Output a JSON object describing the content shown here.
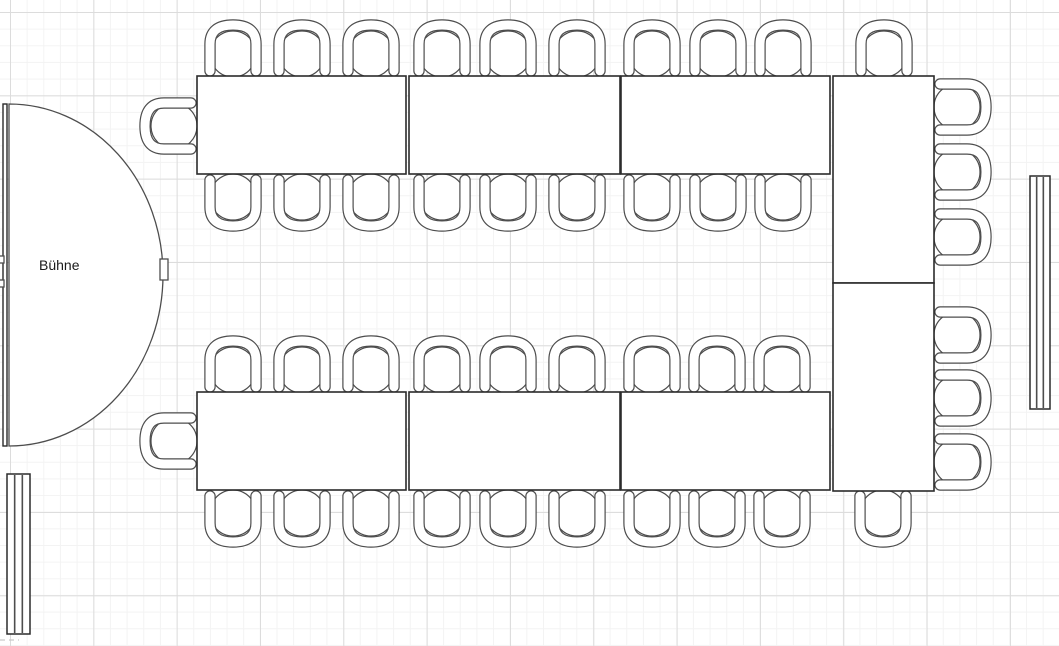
{
  "canvas": {
    "width": 1059,
    "height": 646
  },
  "grid": {
    "minor_spacing": 16.667,
    "major_spacing": 83.333,
    "offset_x": 10,
    "offset_y": 12,
    "minor_color": "#f3f3f3",
    "major_color": "#dcdcdc",
    "background": "#ffffff"
  },
  "colors": {
    "furniture_stroke": "#4d4d4d",
    "table_stroke": "#2b2b2b",
    "fill": "#ffffff",
    "label": "#1a1a1a"
  },
  "stage": {
    "label": "Bühne",
    "x": 3,
    "y": 104,
    "height": 342,
    "band_width": 4,
    "flat_x": 9,
    "rx": 154,
    "ry": 171,
    "tip": {
      "x": 160,
      "y": 259,
      "w": 8,
      "h": 21
    },
    "nubs": [
      {
        "x": -5,
        "y": 256,
        "w": 9,
        "h": 7
      },
      {
        "x": -5,
        "y": 280,
        "w": 9,
        "h": 7
      }
    ]
  },
  "tables": [
    {
      "x": 197,
      "y": 76,
      "w": 209,
      "h": 98
    },
    {
      "x": 409,
      "y": 76,
      "w": 211,
      "h": 98
    },
    {
      "x": 621,
      "y": 76,
      "w": 209,
      "h": 98
    },
    {
      "x": 197,
      "y": 392,
      "w": 209,
      "h": 98
    },
    {
      "x": 409,
      "y": 392,
      "w": 211,
      "h": 98
    },
    {
      "x": 621,
      "y": 392,
      "w": 209,
      "h": 98
    },
    {
      "x": 833,
      "y": 76,
      "w": 101,
      "h": 207
    },
    {
      "x": 833,
      "y": 283,
      "w": 101,
      "h": 208
    }
  ],
  "chairs": [
    {
      "x": 203,
      "y": 18,
      "facing": "down"
    },
    {
      "x": 272,
      "y": 18,
      "facing": "down"
    },
    {
      "x": 341,
      "y": 18,
      "facing": "down"
    },
    {
      "x": 412,
      "y": 18,
      "facing": "down"
    },
    {
      "x": 478,
      "y": 18,
      "facing": "down"
    },
    {
      "x": 547,
      "y": 18,
      "facing": "down"
    },
    {
      "x": 622,
      "y": 18,
      "facing": "down"
    },
    {
      "x": 688,
      "y": 18,
      "facing": "down"
    },
    {
      "x": 753,
      "y": 18,
      "facing": "down"
    },
    {
      "x": 854,
      "y": 18,
      "facing": "down"
    },
    {
      "x": 203,
      "y": 173,
      "facing": "up"
    },
    {
      "x": 272,
      "y": 173,
      "facing": "up"
    },
    {
      "x": 341,
      "y": 173,
      "facing": "up"
    },
    {
      "x": 412,
      "y": 173,
      "facing": "up"
    },
    {
      "x": 478,
      "y": 173,
      "facing": "up"
    },
    {
      "x": 547,
      "y": 173,
      "facing": "up"
    },
    {
      "x": 622,
      "y": 173,
      "facing": "up"
    },
    {
      "x": 688,
      "y": 173,
      "facing": "up"
    },
    {
      "x": 753,
      "y": 173,
      "facing": "up"
    },
    {
      "x": 138,
      "y": 96,
      "facing": "right"
    },
    {
      "x": 203,
      "y": 334,
      "facing": "down"
    },
    {
      "x": 272,
      "y": 334,
      "facing": "down"
    },
    {
      "x": 341,
      "y": 334,
      "facing": "down"
    },
    {
      "x": 412,
      "y": 334,
      "facing": "down"
    },
    {
      "x": 478,
      "y": 334,
      "facing": "down"
    },
    {
      "x": 547,
      "y": 334,
      "facing": "down"
    },
    {
      "x": 622,
      "y": 334,
      "facing": "down"
    },
    {
      "x": 687,
      "y": 334,
      "facing": "down"
    },
    {
      "x": 752,
      "y": 334,
      "facing": "down"
    },
    {
      "x": 138,
      "y": 411,
      "facing": "right"
    },
    {
      "x": 203,
      "y": 489,
      "facing": "up"
    },
    {
      "x": 272,
      "y": 489,
      "facing": "up"
    },
    {
      "x": 341,
      "y": 489,
      "facing": "up"
    },
    {
      "x": 412,
      "y": 489,
      "facing": "up"
    },
    {
      "x": 478,
      "y": 489,
      "facing": "up"
    },
    {
      "x": 547,
      "y": 489,
      "facing": "up"
    },
    {
      "x": 622,
      "y": 489,
      "facing": "up"
    },
    {
      "x": 687,
      "y": 489,
      "facing": "up"
    },
    {
      "x": 752,
      "y": 489,
      "facing": "up"
    },
    {
      "x": 853,
      "y": 489,
      "facing": "up"
    },
    {
      "x": 933,
      "y": 77,
      "facing": "left"
    },
    {
      "x": 933,
      "y": 142,
      "facing": "left"
    },
    {
      "x": 933,
      "y": 207,
      "facing": "left"
    },
    {
      "x": 933,
      "y": 305,
      "facing": "left"
    },
    {
      "x": 933,
      "y": 368,
      "facing": "left"
    },
    {
      "x": 933,
      "y": 432,
      "facing": "left"
    }
  ],
  "walls": [
    {
      "x": 7,
      "y": 474,
      "w": 23,
      "h": 160
    },
    {
      "x": 1030,
      "y": 176,
      "w": 20,
      "h": 233
    }
  ],
  "artifacts": {
    "dash_line": {
      "x1": 0,
      "y1": 640,
      "x2": 19,
      "y2": 640
    }
  }
}
